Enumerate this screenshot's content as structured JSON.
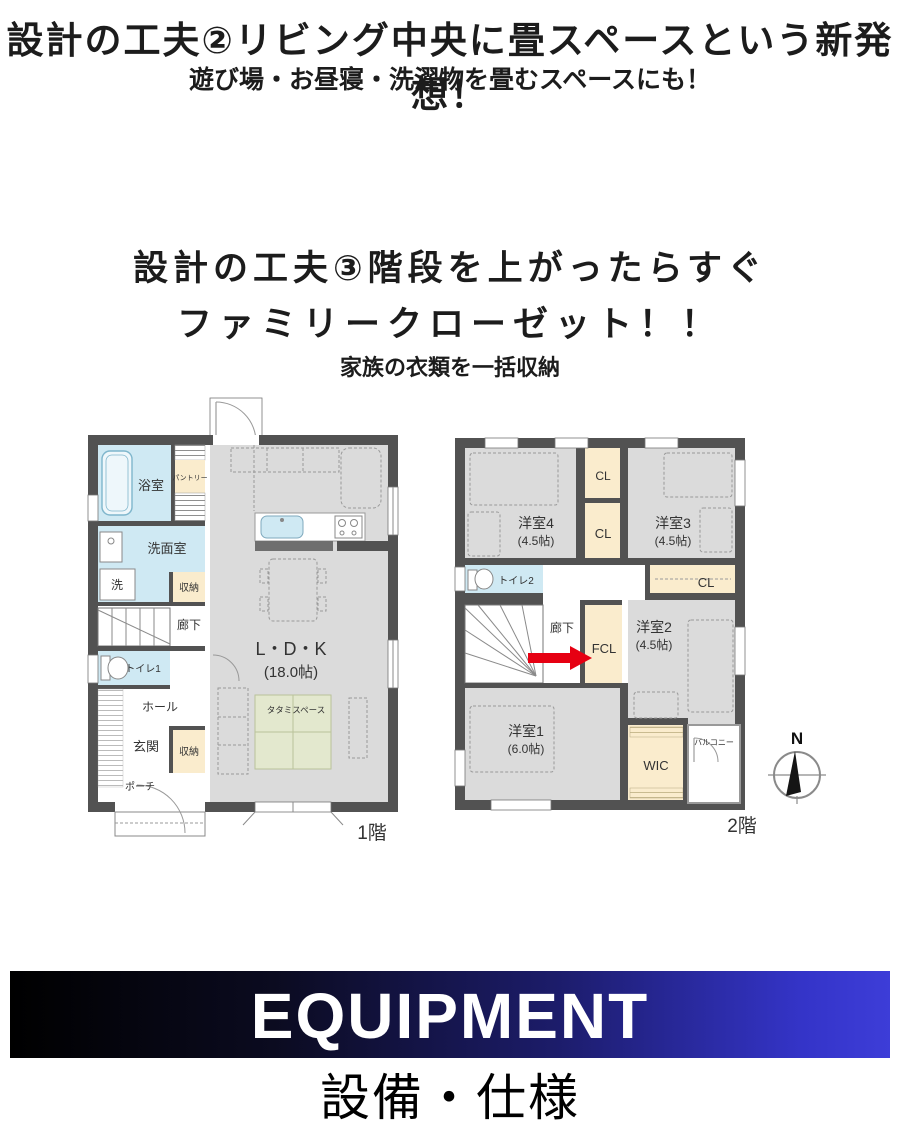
{
  "header": {
    "title": "設計の工夫②リビング中央に畳スペースという新発想！",
    "subtitle": "遊び場・お昼寝・洗濯物を畳むスペースにも！"
  },
  "feature3": {
    "title_line1": "設計の工夫③階段を上がったらすぐ",
    "title_line2": "ファミリークローゼット！！",
    "subtitle": "家族の衣類を一括収納"
  },
  "floor1": {
    "floor_label": "1階",
    "bath": "浴室",
    "pantry": "パントリー",
    "washroom": "洗面室",
    "laundry": "洗",
    "storage_upper": "収納",
    "corridor": "廊下",
    "toilet": "トイレ1",
    "hall": "ホール",
    "entrance": "玄関",
    "storage_lower": "収納",
    "porch": "ポーチ",
    "ldk_name": "L・D・K",
    "ldk_size": "(18.0帖)",
    "tatami": "タタミスペース"
  },
  "floor2": {
    "floor_label": "2階",
    "room4_name": "洋室4",
    "room4_size": "(4.5帖)",
    "room3_name": "洋室3",
    "room3_size": "(4.5帖)",
    "cl_top": "CL",
    "cl_mid": "CL",
    "cl_right": "CL",
    "toilet": "トイレ2",
    "corridor": "廊下",
    "fcl": "FCL",
    "room2_name": "洋室2",
    "room2_size": "(4.5帖)",
    "room1_name": "洋室1",
    "room1_size": "(6.0帖)",
    "wic": "WIC",
    "balcony": "バルコニー"
  },
  "compass": {
    "north": "N"
  },
  "banner": {
    "title": "EQUIPMENT",
    "subtitle": "設備・仕様"
  },
  "colors": {
    "wall": "#525252",
    "room_gray": "#dbdbdb",
    "wet_blue": "#cfe9f3",
    "closet_cream": "#faeccd",
    "tatami_green": "#e3e8ce",
    "arrow_red": "#e60012",
    "banner_left": "#000000",
    "banner_right": "#3d3dd8"
  }
}
